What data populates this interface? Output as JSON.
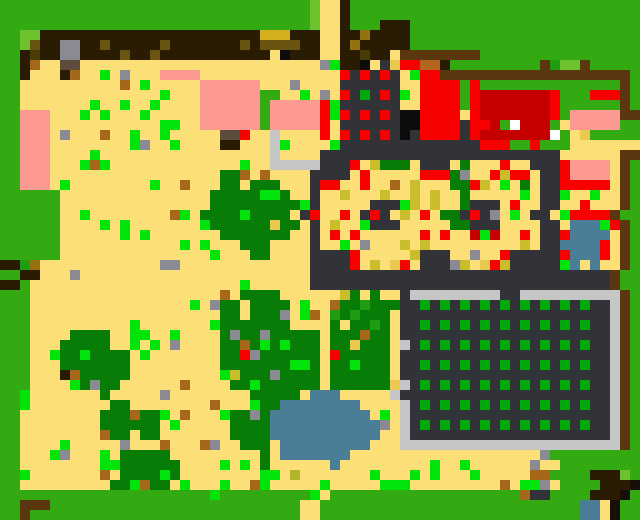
{
  "map": {
    "width_px": 640,
    "height_px": 520,
    "cell_px": 10,
    "cols": 64,
    "rows_count": 52,
    "palette": {
      "G": "#33a912",
      "g": "#6dc22d",
      "d": "#077c07",
      "m": "#1f9c12",
      "f": "#00a80a",
      "v": "#00e40c",
      "S": "#fcdf76",
      "o": "#c9bd2b",
      "O": "#eac94e",
      "D": "#d4af1e",
      "k": "#96720f",
      "u": "#6a5510",
      "z": "#4a3c06",
      "b": "#a5681a",
      "t": "#5d4c3c",
      "B": "#2a1c02",
      "w": "#5a370f",
      "Y": "#8a8a92",
      "P": "#fc9a92",
      "R": "#f80000",
      "r": "#c60000",
      "N": "#0c0c0c",
      "L": "#323338",
      "C": "#c6c6c6",
      "A": "#4a7e96",
      "E": "#181006",
      "W": "#ffffff",
      "n": "#b5651d",
      "q": "#b2b42a"
    },
    "palette_legend": {
      "G": "grass",
      "g": "light-grass",
      "d": "tree-canopy",
      "m": "mid-green",
      "f": "crop-plant",
      "v": "bright-plant",
      "S": "sand",
      "o": "olive-speck",
      "O": "gold-speck",
      "D": "gold-block",
      "k": "dark-gold",
      "u": "dark-olive",
      "z": "darkest-olive",
      "b": "brown-speck",
      "t": "taupe-block",
      "B": "dark-brown",
      "w": "saddle-brown-path",
      "Y": "stone-gray",
      "P": "salmon-pink",
      "R": "bright-red",
      "r": "dark-red",
      "N": "black",
      "L": "slate-wall",
      "C": "silver-frame",
      "A": "water-blue",
      "E": "near-black",
      "W": "white",
      "n": "orange-brown",
      "q": "yellow-olive"
    },
    "features": [
      "grass border around map",
      "dark-brown strip with gray and gold blocks along top",
      "large sand field with scattered plants and stones",
      "pink/salmon patches upper-left and upper-middle",
      "red-dotted slate building top-center",
      "red barn complex with dark-red hall top-right",
      "brown fenced pen with light-green interior",
      "large slate-walled building with sandy flower-dotted interior and two fire pits",
      "small blue pool with red accents right side",
      "fenced crop farm: silver/slate frame, dark soil, green crop grid",
      "blue pond bottom-center",
      "many dark-green trees and a bottom forest clump",
      "sand path columns top-center and bottom-center",
      "dark dock structure with water at bottom-right corner"
    ],
    "rows": [
      "GGGGGGGGGGGGGGGGGGGGGGGGGGGGGGGgSSBGGGGGGGGGGGGGGGGGGGGGGGGGGGGG",
      "GGGGGGGGGGGGGGGGGGGGGGGGGGGGGGGgSSBGGGGGGGGGGGGGGGGGGGGGGGGGGGGG",
      "GGGGGGGGGGGGGGGGGGGGGGGGGGGGGGGgSSBGGGBBBGGGGGGGGGGGGGGGGGGGGGGG",
      "GGggBBBBBBBBBBBBBBBBBBBBBBDDDBBBSSBBkBBBBGGGGGGGGGGGGGGGGGGGGGGG",
      "GGguBBYYBBuBBBBBuBBBBBBBuBuuuuBBSSBkBBBBBGGGGGGGGGGGGGGGGGGGGGGG",
      "GGBzBBYYBBBBuBBuBBBBBBBBBBBSNBBBSSBBzBBSwwwwwwwwGGGGGGGGGGGGGGGG",
      "GGBbSSttSSSSSSSSSSSSSSSSSSSSSSSSYvBBNSLORRnnBGGGGGGGGGwmggwGGGGG",
      "GGBSSSBbSSvSYSSSPPPPSSSSSSSSSSSSSSRLRLRLSvRRwwwwwwwwwwwwwwwwwwwG",
      "GGSSSSSSSSSSbSvSSSSSPPPPPPSSSYSSSSLLLLLLSSRRRRGRGGGGGGGGGGGGGGwG",
      "GGSSSSSSSSSSSSSSvSSSPPPPPPGGSSvSYSRLfLRLvSRRRRGRrrrrrrrRGGGRRRwG",
      "GGSSSSSSSvSSvSSvSSSSPPPPPPGPPPPPRvLLLLLLSSRRRRGRrrrrrrrRGGGGGGwG",
      "GGPPPSSSvSvSSSvSSSSSPPPPPPGPPPPPRvRLRLRLNNRRRRSRrrrrrrrRGPPPPPww",
      "GGPPPSSSSSSSSSSSvvSSPPPPPPGPPPPPRSLLLLLLNNRRRRLRRrGWrrrGSPPPPPGG",
      "GGPPPSYSSSbSSvSSvSSSSSttRSSCSSSSRSRLRLRLNLRRRRLRrrrrrrrWGSOGGGGG",
      "GGPPPSSSSSSSSvYSSvSSSSBBSSSCvSSSSvLLLLLLLLLLLLLLRRRGGRGGGSSSSSSS",
      "GGPPPSSSSvSSSSSSSSSSSSSSSSSCSSSSLLLLLLLLLLLLLLLLLLLLLLLLSSSSSSww",
      "GGPPPSSSvbvSSSSSSSSSSSSSvSSCCCCCLLLRSodddSLLLSdSSSRSSLLLRPPPPSwG",
      "GGPPPSSSSSSSSSSSSSSSSSddbSbSSSSLLLLSRSSSSSRRRdYSSRoRRSLLRPPPPSwG",
      "GGPPPSvSSSSSSSSvSSbSSSddSdddSSSLRRSSRSSbSoSSSddRoSvSdSLLRRRRRSwG",
      "GGGGGGSSSSSSSSSSSSSSSdddddvvdSSLSSoSSSoSSoSoSSdSSSSSvSLLvSSvSSwG",
      "GGGGGGSSSSSSSSSSSSSSSdddddddddvLSSSSSLLLvoSoSSdLLLSRSSLLSSRSSSwG",
      "GGGGGGSSvSSSSSSSSbvSddddvddddSLRSSRSLRLSoSRSddLRLYSvSLLSvRRRRwG",
      "GGGGGGSSSSvSvSSSSSSSvddddddOddSLSoSSvLLLSSSSSddLLLSSSSLLSAAAvRwG",
      "GGGGGGSSSSSSvSvSSSSSSSdddddddSSLSRSRSSSSSSRSRSSrvrSSRSLLRAAAASwG",
      "GGGGGGSSSSSSSSSSSSvSvSSSdddSSSSLSSvSYSSSoSoSSSSSSSSSoSLLAAAARSwG",
      "GGGGGGSSSSSSSSSSSSSSSvSSSddSSSSLLLLRSSSSSoLLLSSYSSRLLLLLRAAARSwG",
      "BBmkSSSSSSSSSSSSYYSSSSSSSSSSSSSLLLLRSoSORSLLLYoSORoLLLLLvASASSwG",
      "GGBBSSSYSSSSSSSSSSSSSSSSSSSSSSSLLLLLLLLLLLLLLLLLLLLLLLLLLLLLLwG",
      "BBGSSSSSSSSSSSSSSSSSSSSSvSSSSSSLLLLLLLLLLLLLLLLLLLLLLLLLLLLLLwG",
      "GGGSSSSSSSSSSSSSSSSSSSbSddddSSSSSSodSdSSLCCCCCCCCCLLCCCCCCCCCCwG",
      "GGGSSSSSSSSSSSSSSSSvSYddSddddSvSSbddmdddLLfLfLfLfLfLfLfLfLfLLCwG",
      "GGGSSSSSSSSSSSSSSSSSSSddSdddYSvbSmdmdddSLLLLLLLLLLLLLLLLLLLLLCwG",
      "GGGSSSSSSSSSSvSSSSSSSvdddddddSSSSdSddmdSLLfLfLfLfLfLfLfLfLfLLCwG",
      "GGGSSSSddddSSvvSSvSSSSdYddYdddddSdddbddSLLLLLLLLLLLLLLLLLLLLLCwG",
      "GGGSSSdddddSSvSvSYSSSSddbdvdvdddSddOdddSCLfLfLfLfLfLfLfLfLfLLCwG",
      "GGGSSvddvddddSvSSSSSSSddRYddddddSRdddddSLLLLLLLLLLLLLLLLLLLLLCwG",
      "GGGSSSdddddddSSSSSSSSSdddddddvvdSddvdddSLLfLfLfLfLfLfLfLfLfLLCwG",
      "GGGSSSBbdddddSSSSSSSSSvodddYddddSddddddSLLLLLLLLLLLLLLLLLLLLLCwG",
      "GGGSSSSvdYddSSSSSSbSSSSddvddddddSddddddOCLfLfLfLfLfLfLfLfLfLLCwG",
      "GGvSSSSSSSdSSSSSYSSSSSSSSdddddSAAASSSSSCLLLLLLLLLLLLLLLLLLLLLCwG",
      "GGvSSSSSSSSddSSSSSSSSbSSSvddAAAAAAAASSSSCLfLfLfLfLfLfLfLfLfLLCwG",
      "GGSSSSSSSSdddbddvSbSSSvddYdAAAAAAAAAASvSCLLLLLLLLLLLLLLLLLLLLCwG",
      "GGSSSSSSSSddddddSvSSSSSddddAAAAAAAAAAAYSCLfLfLfLfLfLfLfLfLfLLCwG",
      "GGSSSSSSSSbddSddSSSSSSSddddAAAAAAAAAAASSCLLLLLLLLLLLLLLLLLLLLCwG",
      "GGSSSSvSSSSSYSSSbSSSbYSSdddSAAAAAAAAASSSCCCCCCCCCCCCCCCCCCCCCCwG",
      "GGSSSvYSSSvSdddddSSSSSSSSSdSAAAAAAASSSSSSSSSSSSSSSSSSSYGGGGGGGGG",
      "GGSSSSSSSSvvddddddSSSSvSvSdSSSSSSASSSSSSSSSvSSvSSSSSSYSSGGGGGGGG",
      "GGvSSSSSSSbSddddvdSSSSSSSSvvSqSSSSSSSvSSSvSvSSSvSSSSSbbGGGGBBBg",
      "GGSSSSSSSSSddvbddSvSSSvSSbvSSSSSvSSSSSvvvSSSSSSSSSbSvvYSGGGGBBBE",
      "GGGGGGGGGGGGGGGGGGGGGvGGGGGGGGGvSGGGGGGGGGGGGGGGGGGGbLLGGGGBBBE",
      "GGwwwGGGGGGGGGGGGGGGGGGGGGGGGGSSGGGGGGGGGGGGGGGGGGGGGGGGGGAASE",
      "GGwGGGGGGGGGGGGGGGGGGGGGGGGGGGSSGGGGGGGGGGGGGGGGGGGGGGGGGGAASE",
      "GGwGGGGGGGGGGGGGGGGGGGGGGGGGGGSSGGGGGGGGGGGGGGGGGGGGGGGGGGAASE"
    ]
  }
}
